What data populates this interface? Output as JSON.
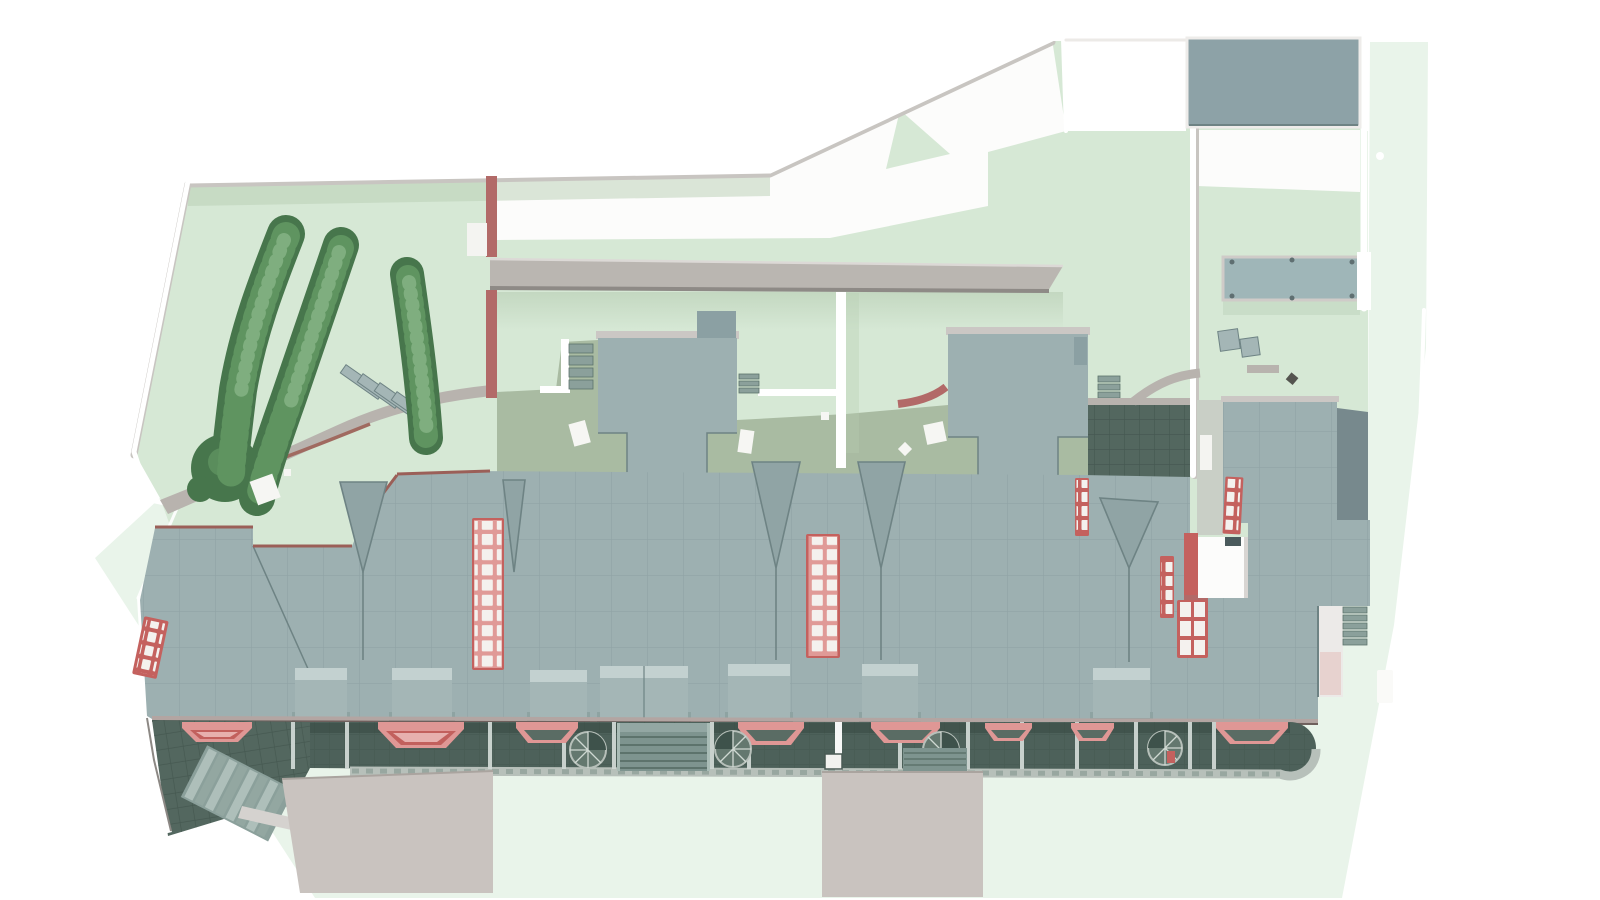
{
  "palette": {
    "page_bg": "#ffffff",
    "outer_ground": "#e9f4ea",
    "site_ground": "#d6e8d5",
    "shade_green": "#b7cdb3",
    "court_white": "#fcfcfb",
    "wall_white": "#ffffff",
    "wall_shadow": "#c8c5c1",
    "beam_gray": "#bab6b1",
    "beam_edge": "#8e8a86",
    "beam_light": "#dcd9d6",
    "red_wall": "#b26a68",
    "red_frame": "#c4615e",
    "red_light": "#e09a97",
    "pane_white": "#f4f1ee",
    "fascia_brown": "#9b5f58",
    "fascia_light": "#cbc7c4",
    "roof": "#9db0b1",
    "roof_seam": "#84989a",
    "roof_dark": "#6e8384",
    "dormer": "#a4b6b6",
    "dormer_light": "#c3d1d0",
    "dormer_dark": "#8ea3a2",
    "sage": "#a9bba2",
    "patio": "#53675f",
    "patio_grid": "#42544d",
    "walkway_dark": "#4d615a",
    "curb": "#b7c0ba",
    "curb_tick": "#98a7a0",
    "canopy_pink": "#df9795",
    "canopy_dark": "#c2605d",
    "canopy_inner": "#5a6c64",
    "stair_teal": "#8ba09b",
    "stair_light": "#a9bcb6",
    "stair_line": "#5d736c",
    "spiral": "#64786f",
    "spiral_line": "#cfd8d2",
    "hedge_dark": "#47764c",
    "hedge_mid": "#5f9460",
    "hedge_light": "#7fae7f",
    "path_gray": "#b8b3ae",
    "path_edge": "#a06a60",
    "pad": "#c9c3bf",
    "pad_edge": "#aaa49f",
    "deck": "#9fb6b8",
    "deck_frame": "#cfcbc8",
    "alley": "#c9cfc6",
    "shadow_band": "#77898d",
    "ramp_white": "#eceae8",
    "ramp_pink": "#e7d2cf",
    "dark_obj": "#54544f",
    "block_ne": "#8da2a7"
  },
  "scene": {
    "kind": "aerial-architectural-render",
    "skylight_strip_count": 7,
    "pink_canopy_count": 8,
    "spiral_stair_count": 4,
    "hedge_row_count": 4,
    "dormer_box_count": 7
  }
}
